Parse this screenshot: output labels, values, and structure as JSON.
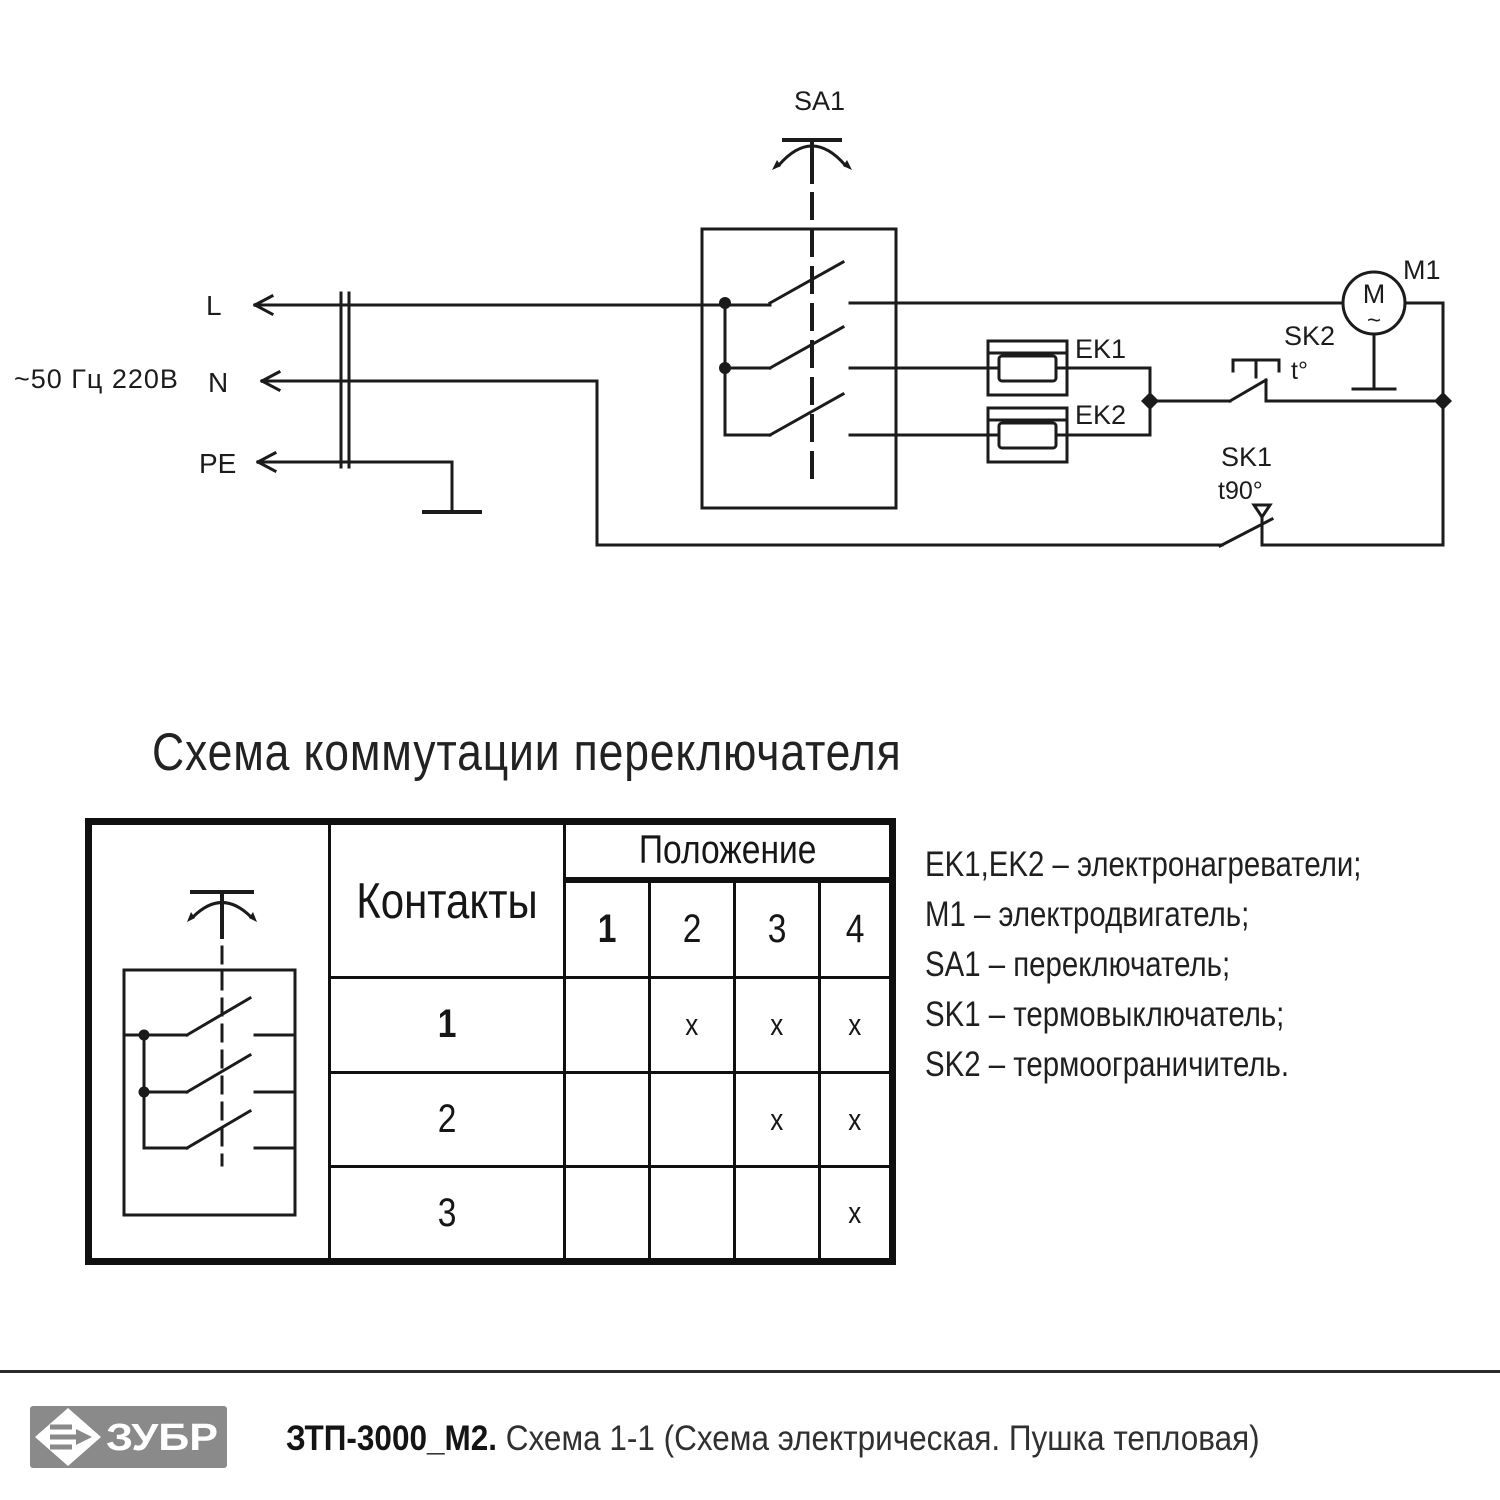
{
  "schematic": {
    "power_label": "~50 Гц 220В",
    "terminal_l": "L",
    "terminal_n": "N",
    "terminal_pe": "PE",
    "switch": "SA1",
    "heater_1": "EK1",
    "heater_2": "EK2",
    "thermal_limiter": "SK2",
    "thermal_limiter_temp": "t°",
    "thermal_cutout": "SK1",
    "thermal_cutout_temp": "t90°",
    "motor": "M1",
    "motor_letter": "M",
    "motor_ac": "~",
    "ink_color": "#1b1b1b"
  },
  "switch_table": {
    "title": "Схема коммутации переключателя",
    "contacts_header": "Контакты",
    "position_header": "Положение",
    "positions": [
      "1",
      "2",
      "3",
      "4"
    ],
    "rows": [
      {
        "contact": "1",
        "marks": [
          "",
          "x",
          "x",
          "x"
        ]
      },
      {
        "contact": "2",
        "marks": [
          "",
          "",
          "x",
          "x"
        ]
      },
      {
        "contact": "3",
        "marks": [
          "",
          "",
          "",
          "x"
        ]
      }
    ]
  },
  "legend": {
    "items": [
      "EK1,EK2 – электронагреватели;",
      "M1 – электродвигатель;",
      "SA1 – переключатель;",
      "SK1 – термовыключатель;",
      "SK2 – термоограничитель."
    ]
  },
  "footer": {
    "brand": "ЗУБР",
    "model": "ЗТП-3000_М2.",
    "description": "Схема 1-1 (Схема электрическая. Пушка тепловая)",
    "logo_bg": "#8a8a8a"
  }
}
